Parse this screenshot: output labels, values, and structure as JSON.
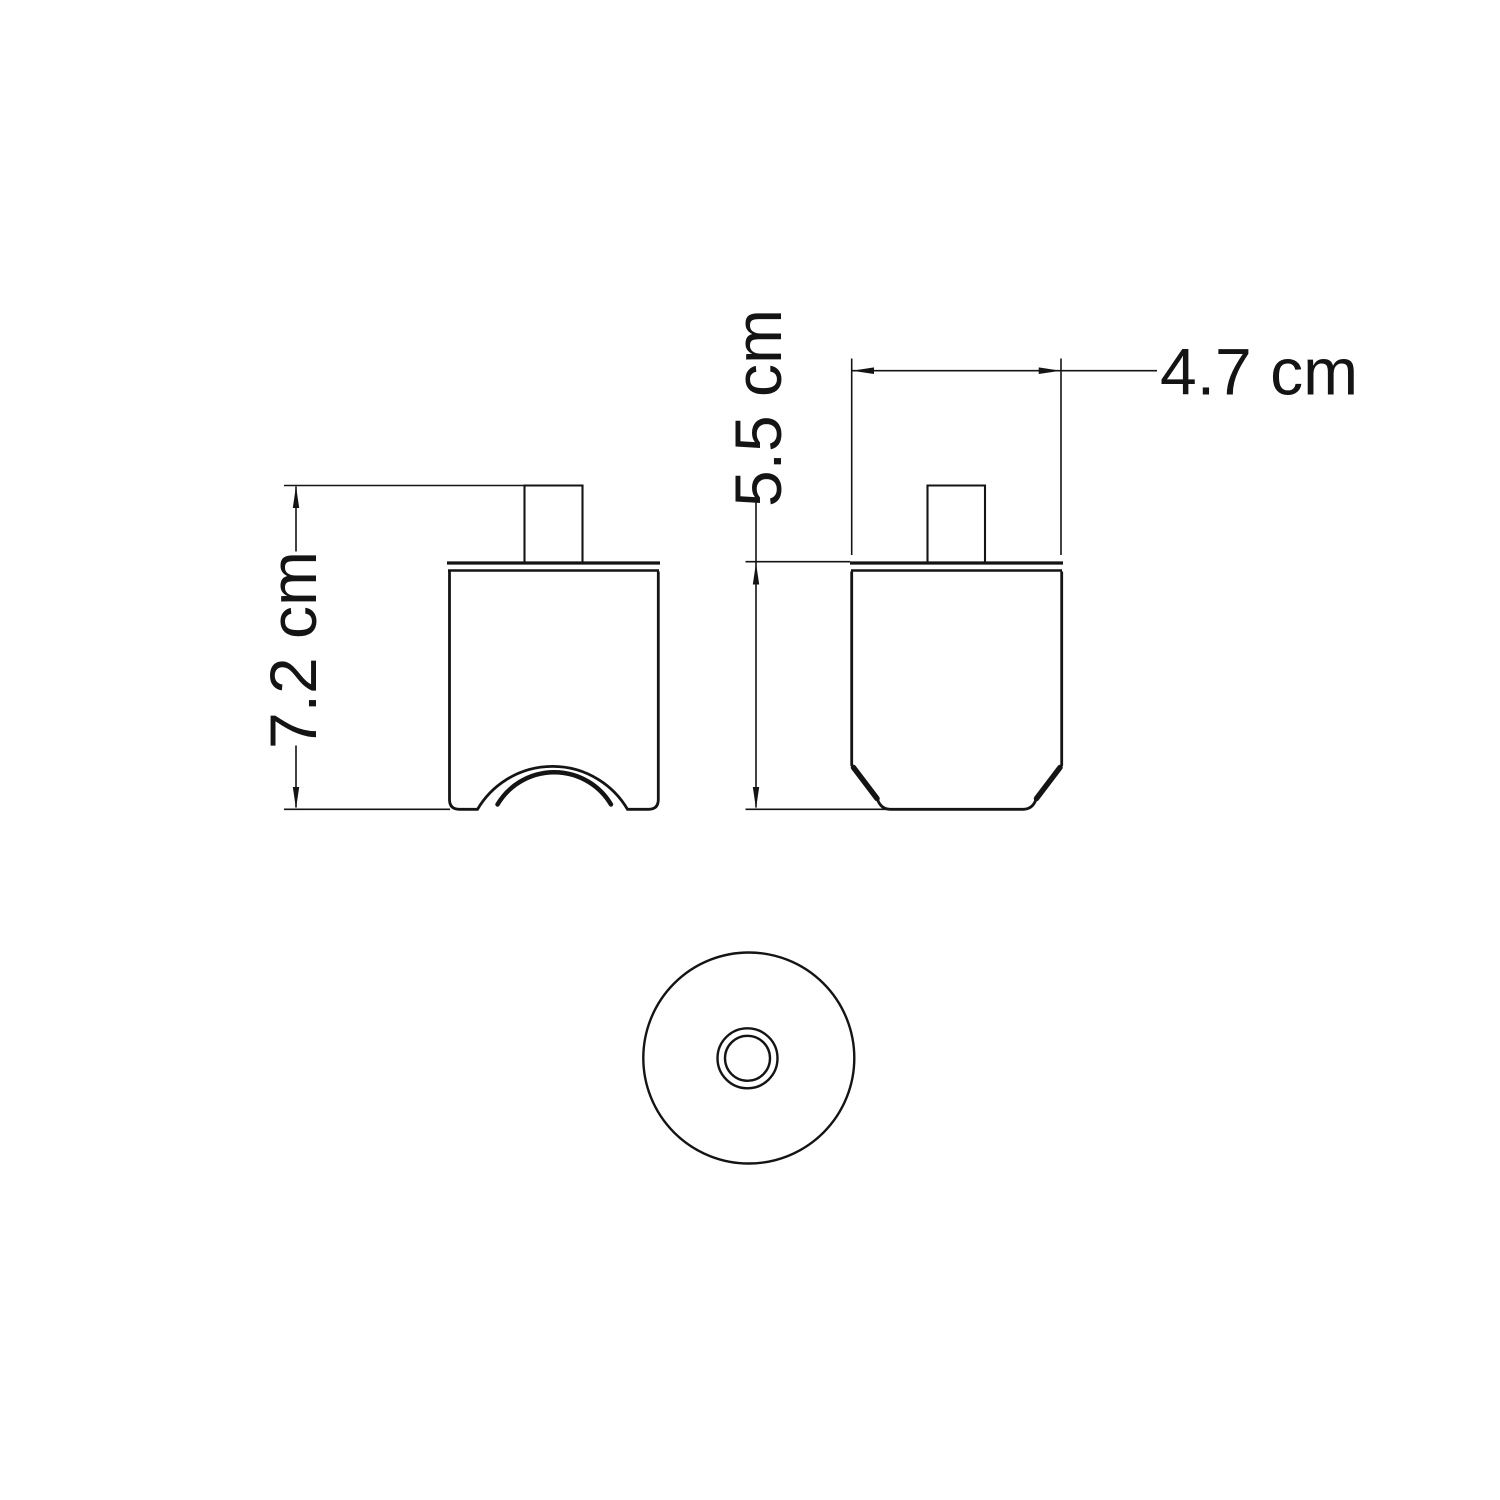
{
  "page": {
    "background": "#ffffff",
    "ink_color": "#141414"
  },
  "views": {
    "front": {
      "height_dim": {
        "label": "7.2 cm",
        "value_cm": 7.2
      }
    },
    "side": {
      "height_dim": {
        "label": "5.5 cm",
        "value_cm": 5.5
      },
      "width_dim": {
        "label": "4.7 cm",
        "value_cm": 4.7
      }
    },
    "bottom": {}
  }
}
